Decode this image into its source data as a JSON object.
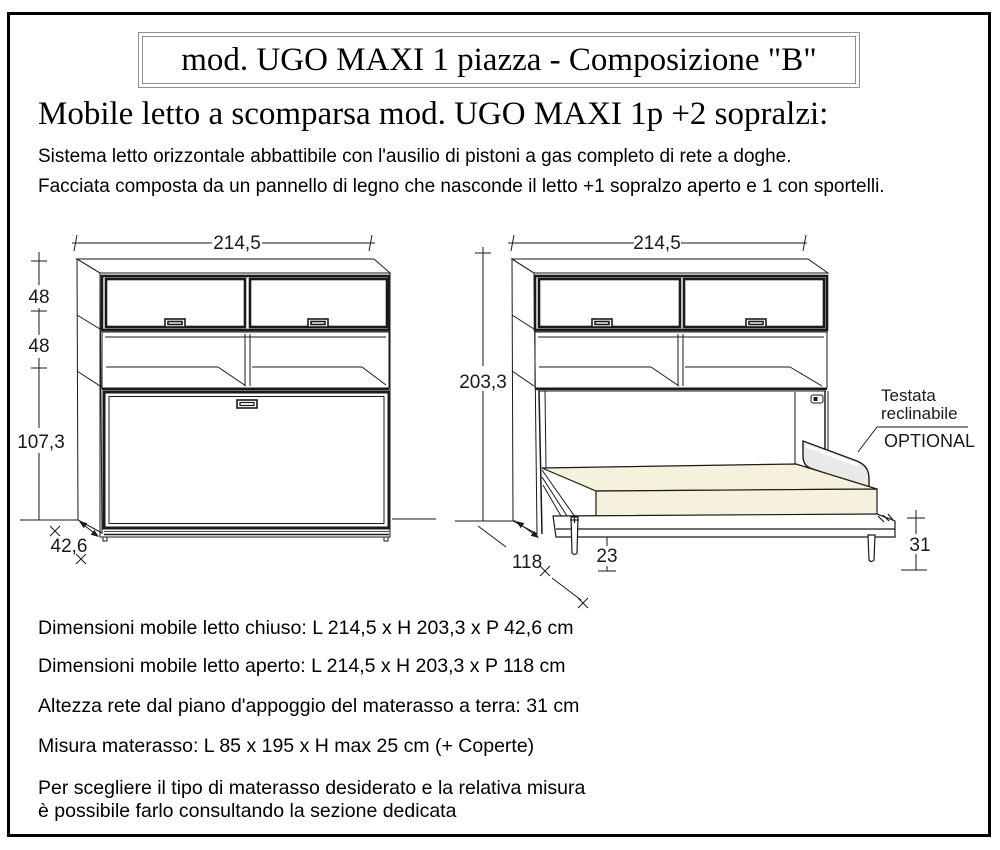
{
  "page": {
    "title_box": "mod. UGO MAXI 1 piazza - Composizione \"B\"",
    "heading": "Mobile letto a scomparsa mod. UGO MAXI 1p +2 sopralzi:",
    "description_lines": [
      "Sistema letto orizzontale  abbattibile con l'ausilio di pistoni a gas completo di rete a doghe.",
      "Facciata composta da un pannello di legno che nasconde il letto +1 sopralzo aperto e 1 con sportelli."
    ]
  },
  "diagram": {
    "closed_unit": {
      "width_cm": "214,5",
      "top_section_height_cm": "48",
      "middle_section_height_cm": "48",
      "bottom_section_height_cm": "107,3",
      "depth_cm": "42,6"
    },
    "open_unit": {
      "width_cm": "214,5",
      "height_cm": "203,3",
      "depth_cm": "118",
      "leg_height_cm": "23",
      "bed_height_cm": "31",
      "headboard_label_line1": "Testata",
      "headboard_label_line2": "reclinabile",
      "headboard_option": "OPTIONAL"
    }
  },
  "specs": {
    "lines": [
      "Dimensioni mobile letto chiuso: L 214,5 x H 203,3 x P 42,6 cm",
      "Dimensioni mobile letto aperto: L 214,5 x H 203,3 x P 118 cm",
      "Altezza rete dal piano d'appoggio del materasso a terra: 31 cm",
      "Misura materasso: L 85 x 195 x H max 25 cm  (+ Coperte)",
      "Per scegliere il tipo di materasso desiderato e la relativa misura",
      "è possibile farlo consultando la sezione dedicata"
    ]
  },
  "colors": {
    "mattress": "#f6f1dc",
    "headboard": "#e9e9e9",
    "line": "#1a1a1a",
    "box_border": "#8f8f8f"
  }
}
